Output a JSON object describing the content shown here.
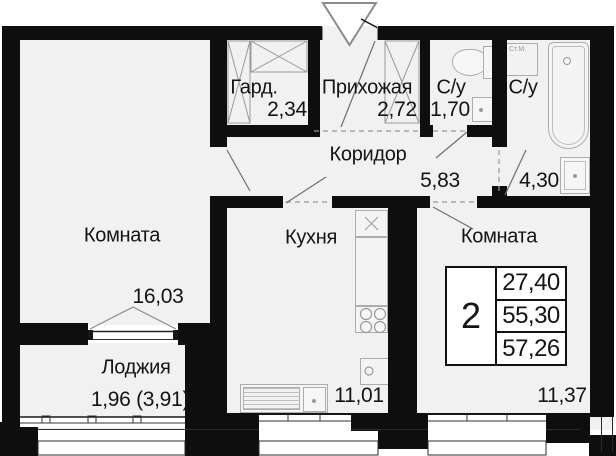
{
  "plan_type": "floor-plan",
  "rooms": {
    "room1": {
      "name": "Комната",
      "area": "16,03"
    },
    "gard": {
      "name": "Гард.",
      "area": "2,34"
    },
    "hallway": {
      "name": "Прихожая",
      "area": "2,72"
    },
    "bath1": {
      "name": "С/у",
      "area": "1,70"
    },
    "bath2": {
      "name": "С/у",
      "area": "4,30"
    },
    "corridor": {
      "name": "Коридор",
      "area": "5,83"
    },
    "kitchen": {
      "name": "Кухня",
      "area": "11,01"
    },
    "room2": {
      "name": "Комната",
      "area": "11,37"
    },
    "loggia": {
      "name": "Лоджия",
      "area": "1,96 (3,91)"
    }
  },
  "info": {
    "rooms_count": "2",
    "values": [
      "27,40",
      "55,30",
      "57,26"
    ]
  },
  "labels": {
    "washing_machine": "Ст.М."
  },
  "colors": {
    "wall": "#0e0e0e",
    "floor": "#f1f1f1",
    "fixture_stroke": "#adadad",
    "text": "#141414"
  }
}
